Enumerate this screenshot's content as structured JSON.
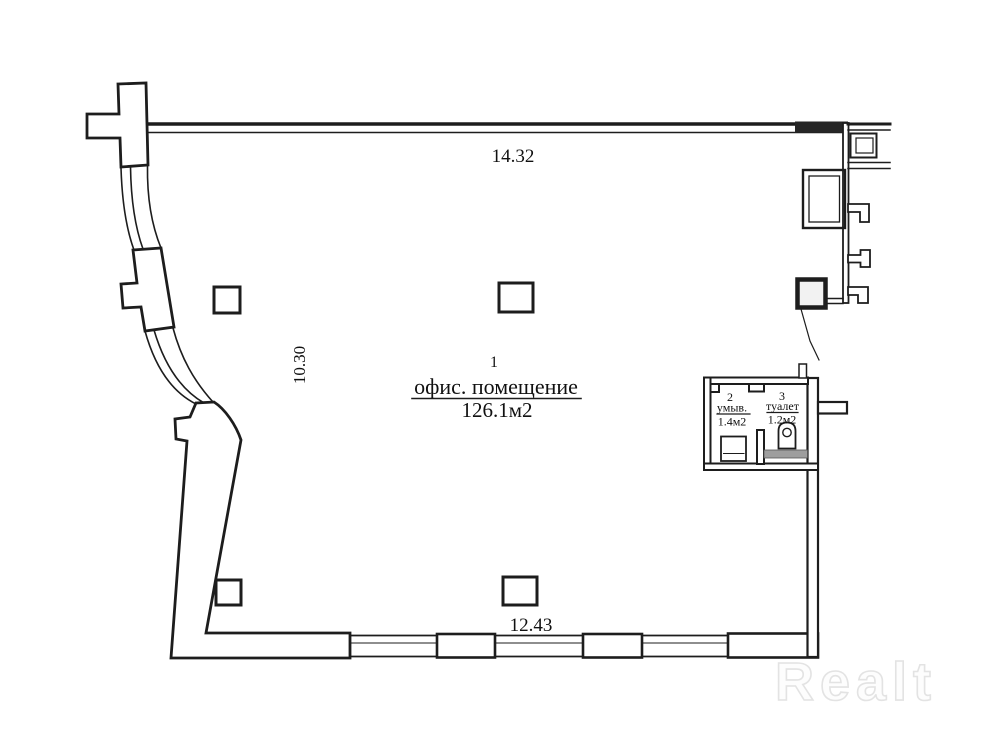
{
  "dimensions": {
    "top": "14.32",
    "left": "10.30",
    "bottom": "12.43"
  },
  "rooms": {
    "office": {
      "number": "1",
      "name": "офис. помещение",
      "area": "126.1м2"
    },
    "washroom": {
      "number": "2",
      "name": "умыв.",
      "area": "1.4м2"
    },
    "toilet": {
      "number": "3",
      "name": "туалет",
      "area": "1.2м2"
    }
  },
  "watermark": {
    "text": "Realt"
  },
  "colors": {
    "wall": "#1d1d1d",
    "background": "#ffffff",
    "fixture_band": "#9e9e9e",
    "watermark_fill": "#fdfdfd",
    "watermark_outline": "#e3e3e3"
  }
}
